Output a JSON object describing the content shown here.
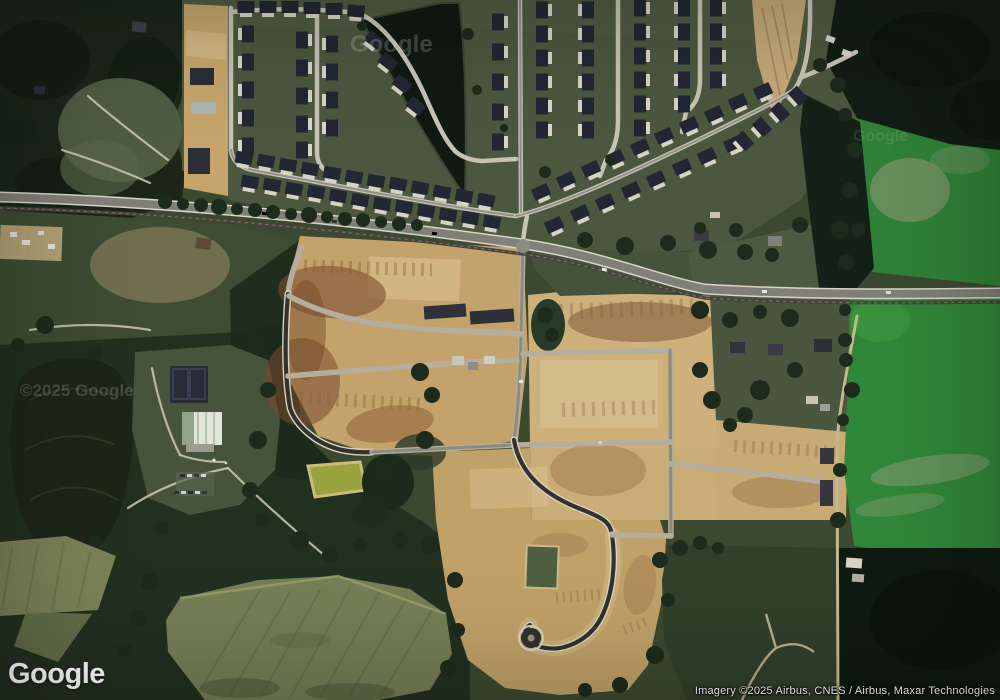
{
  "map": {
    "type": "satellite-imagery",
    "logo": "Google",
    "attribution": "Imagery ©2025 Airbus, CNES / Airbus, Maxar Technologies",
    "watermarks": [
      "Google",
      "©2025 Google",
      "Google"
    ]
  },
  "colors": {
    "roof": "#232733",
    "pad": "#d7d3c5",
    "street": "#c6c3b5",
    "street_core": "#93908a",
    "highway_edge": "#d8d5c8",
    "highway": "#807f78",
    "rail": "#46443c",
    "asphalt_new": "#33322e",
    "dirt": "#c5a56c",
    "dirt_light": "#dcc494",
    "soil_red": "#7d4e30",
    "forest": "#1b2619",
    "forest_black": "#0f1a11",
    "grass": "#4c573f",
    "scrub": "#3e4c34",
    "field_bright": "#2f8237",
    "field_dark": "#31402b",
    "field_pale": "#757e55",
    "water": "#101a11",
    "pond_olive": "#9aa23e",
    "slab": "#2e3138"
  }
}
